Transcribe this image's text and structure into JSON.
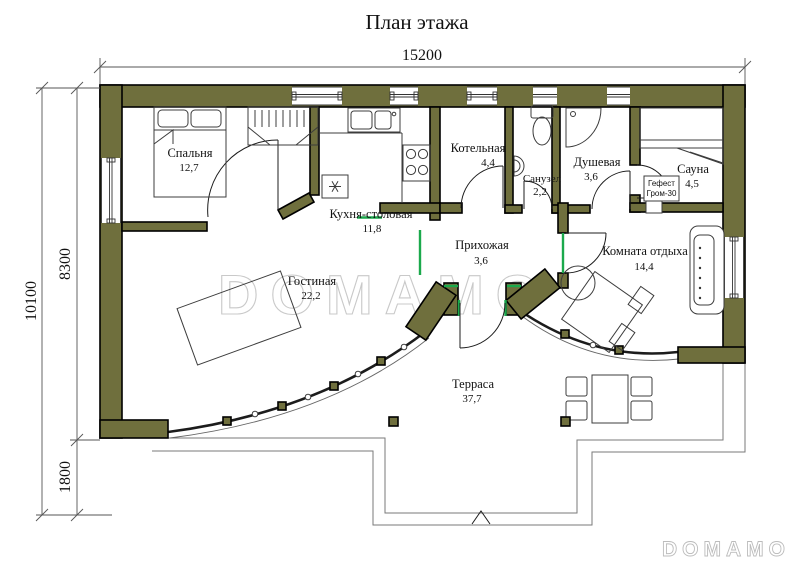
{
  "title": "План этажа",
  "dimensions": {
    "top_width": "15200",
    "left_total": "10100",
    "left_upper": "8300",
    "left_lower": "1800"
  },
  "rooms": [
    {
      "name": "Спальня",
      "area": "12,7"
    },
    {
      "name": "Кухня-столовая",
      "area": "11,8"
    },
    {
      "name": "Котельная",
      "area": "4,4"
    },
    {
      "name": "Санузел",
      "area": "2,2"
    },
    {
      "name": "Душевая",
      "area": "3,6"
    },
    {
      "name": "Сауна",
      "area": "4,5"
    },
    {
      "name": "Прихожая",
      "area": "3,6"
    },
    {
      "name": "Комната отдыха",
      "area": "14,4"
    },
    {
      "name": "Гостиная",
      "area": "22,2"
    },
    {
      "name": "Терраса",
      "area": "37,7"
    }
  ],
  "equipment": {
    "sauna_stove_line1": "Гефест",
    "sauna_stove_line2": "Гром-30"
  },
  "watermark": {
    "center": "DOMAMO",
    "corner": "DOMAMO"
  },
  "colors": {
    "wall": "#6f6f3d",
    "door_mark_green": "#1ba94c",
    "watermark_gray": "#c9c9c9"
  }
}
